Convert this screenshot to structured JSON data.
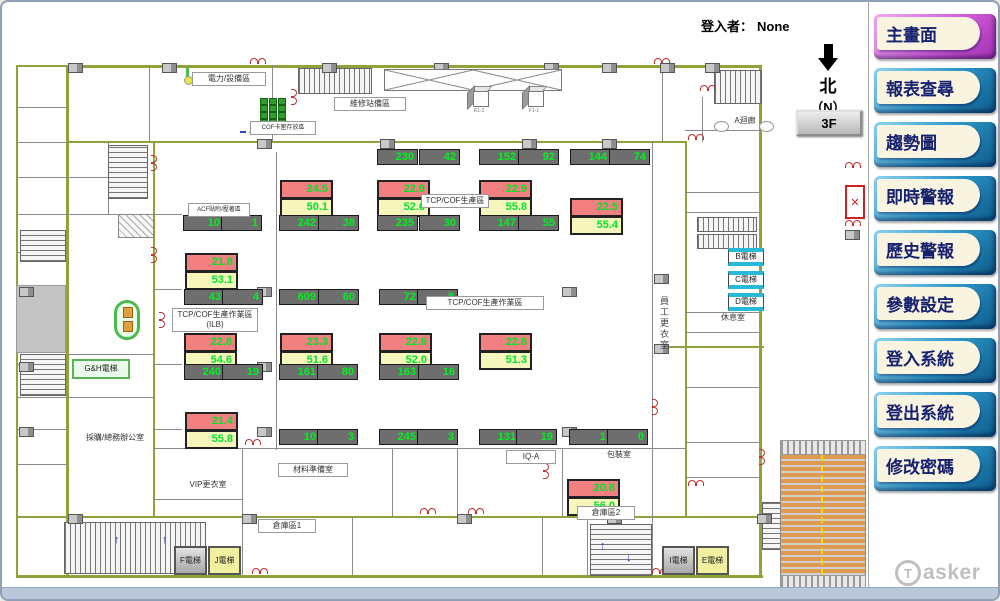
{
  "header": {
    "login_label": "登入者：",
    "login_value": "None"
  },
  "compass": {
    "char": "北",
    "sub": "（N）",
    "floor_button": "3F"
  },
  "sidebar": {
    "buttons": [
      {
        "name": "main-screen",
        "label": "主畫面",
        "active": true
      },
      {
        "name": "report-query",
        "label": "報表查尋",
        "active": false
      },
      {
        "name": "trend-chart",
        "label": "趨勢圖",
        "active": false
      },
      {
        "name": "realtime-alarm",
        "label": "即時警報",
        "active": false
      },
      {
        "name": "history-alarm",
        "label": "歷史警報",
        "active": false
      },
      {
        "name": "parameter-settings",
        "label": "參數設定",
        "active": false
      },
      {
        "name": "login-system",
        "label": "登入系統",
        "active": false
      },
      {
        "name": "logout-system",
        "label": "登出系統",
        "active": false
      },
      {
        "name": "change-password",
        "label": "修改密碼",
        "active": false
      }
    ],
    "logo": {
      "initial": "T",
      "rest": "asker"
    }
  },
  "floorplan": {
    "colors": {
      "wall": "#8fa33b",
      "temp_box": "#f28080",
      "hum_box": "#f6f6bc",
      "count_box": "#6e6e6e",
      "value_text": "#00e428"
    },
    "sensor_pairs": [
      {
        "temp": "24.5",
        "hum": "50.1",
        "x": 278,
        "y": 178
      },
      {
        "temp": "22.9",
        "hum": "52.6",
        "x": 375,
        "y": 178
      },
      {
        "temp": "22.9",
        "hum": "55.8",
        "x": 477,
        "y": 178
      },
      {
        "temp": "22.5",
        "hum": "55.4",
        "x": 568,
        "y": 196
      },
      {
        "temp": "21.8",
        "hum": "53.1",
        "x": 183,
        "y": 251
      },
      {
        "temp": "22.8",
        "hum": "54.6",
        "x": 182,
        "y": 331
      },
      {
        "temp": "23.3",
        "hum": "51.6",
        "x": 278,
        "y": 331
      },
      {
        "temp": "22.6",
        "hum": "52.0",
        "x": 377,
        "y": 331
      },
      {
        "temp": "22.8",
        "hum": "51.3",
        "x": 477,
        "y": 331
      },
      {
        "temp": "21.4",
        "hum": "55.8",
        "x": 183,
        "y": 410
      },
      {
        "temp": "20.8",
        "hum": "56.0",
        "x": 565,
        "y": 477
      }
    ],
    "counters": [
      {
        "v": "230",
        "x": 375,
        "y": 147
      },
      {
        "v": "42",
        "x": 417,
        "y": 147
      },
      {
        "v": "152",
        "x": 477,
        "y": 147
      },
      {
        "v": "92",
        "x": 516,
        "y": 147
      },
      {
        "v": "144",
        "x": 568,
        "y": 147
      },
      {
        "v": "74",
        "x": 607,
        "y": 147
      },
      {
        "v": "10",
        "x": 181,
        "y": 213
      },
      {
        "v": "1",
        "x": 219,
        "y": 213
      },
      {
        "v": "242",
        "x": 277,
        "y": 213
      },
      {
        "v": "38",
        "x": 316,
        "y": 213
      },
      {
        "v": "235",
        "x": 375,
        "y": 213
      },
      {
        "v": "30",
        "x": 417,
        "y": 213
      },
      {
        "v": "147",
        "x": 477,
        "y": 213
      },
      {
        "v": "55",
        "x": 516,
        "y": 213
      },
      {
        "v": "43",
        "x": 182,
        "y": 287
      },
      {
        "v": "4",
        "x": 220,
        "y": 287
      },
      {
        "v": "609",
        "x": 277,
        "y": 287
      },
      {
        "v": "60",
        "x": 316,
        "y": 287
      },
      {
        "v": "72",
        "x": 377,
        "y": 287
      },
      {
        "v": "8",
        "x": 415,
        "y": 287
      },
      {
        "v": "240",
        "x": 182,
        "y": 362
      },
      {
        "v": "19",
        "x": 220,
        "y": 362
      },
      {
        "v": "161",
        "x": 277,
        "y": 362
      },
      {
        "v": "80",
        "x": 315,
        "y": 362
      },
      {
        "v": "163",
        "x": 377,
        "y": 362
      },
      {
        "v": "16",
        "x": 416,
        "y": 362
      },
      {
        "v": "10",
        "x": 277,
        "y": 427
      },
      {
        "v": "3",
        "x": 315,
        "y": 427
      },
      {
        "v": "245",
        "x": 377,
        "y": 427
      },
      {
        "v": "3",
        "x": 415,
        "y": 427
      },
      {
        "v": "131",
        "x": 477,
        "y": 427
      },
      {
        "v": "19",
        "x": 514,
        "y": 427
      },
      {
        "v": "1",
        "x": 567,
        "y": 427
      },
      {
        "v": "0",
        "x": 605,
        "y": 427
      }
    ],
    "room_labels": [
      {
        "t": "電力/設備區",
        "x": 190,
        "y": 70,
        "w": 68,
        "plain": false
      },
      {
        "t": "維修站備區",
        "x": 332,
        "y": 95,
        "w": 66,
        "plain": false
      },
      {
        "t": "COF卡匣存放區",
        "x": 248,
        "y": 119,
        "w": 60,
        "plain": false,
        "small": true
      },
      {
        "t": "TCP/COF生產區",
        "x": 419,
        "y": 192,
        "w": 62,
        "plain": false
      },
      {
        "t": "ACF貼附/壓著區",
        "x": 186,
        "y": 201,
        "w": 56,
        "plain": false,
        "small": true
      },
      {
        "t": "TCP/COF生產作業區\n(ILB)",
        "x": 170,
        "y": 306,
        "w": 80,
        "plain": false
      },
      {
        "t": "TCP/COF生產作業區",
        "x": 424,
        "y": 294,
        "w": 112,
        "plain": false
      },
      {
        "t": "IQ-A",
        "x": 504,
        "y": 448,
        "w": 44,
        "plain": false
      },
      {
        "t": "包裝室",
        "x": 590,
        "y": 447,
        "w": 50,
        "plain": true
      },
      {
        "t": "材料準備室",
        "x": 276,
        "y": 461,
        "w": 64,
        "plain": false
      },
      {
        "t": "VIP更衣室",
        "x": 176,
        "y": 477,
        "w": 56,
        "plain": true
      },
      {
        "t": "倉庫區1",
        "x": 256,
        "y": 517,
        "w": 52,
        "plain": false
      },
      {
        "t": "倉庫區2",
        "x": 575,
        "y": 504,
        "w": 52,
        "plain": false
      },
      {
        "t": "採購/總務辦公室",
        "x": 74,
        "y": 430,
        "w": 74,
        "plain": true
      },
      {
        "t": "休息室",
        "x": 710,
        "y": 310,
        "w": 38,
        "plain": true
      },
      {
        "t": "A迴廊",
        "x": 726,
        "y": 113,
        "w": 30,
        "plain": true
      }
    ],
    "vertical_labels": [
      {
        "t": "員工更衣室",
        "x": 656,
        "y": 294
      }
    ],
    "elevators": [
      {
        "t": "G&H電梯",
        "x": 70,
        "y": 357,
        "w": 58,
        "h": 20,
        "style": "green"
      },
      {
        "t": "B電梯",
        "x": 726,
        "y": 246,
        "w": 36,
        "h": 18,
        "style": "cyan"
      },
      {
        "t": "C電梯",
        "x": 726,
        "y": 269,
        "w": 36,
        "h": 18,
        "style": "cyan"
      },
      {
        "t": "D電梯",
        "x": 726,
        "y": 291,
        "w": 36,
        "h": 18,
        "style": "cyan"
      },
      {
        "t": "F電梯",
        "x": 172,
        "y": 544,
        "w": 33,
        "h": 29,
        "style": "gray"
      },
      {
        "t": "J電梯",
        "x": 206,
        "y": 544,
        "w": 33,
        "h": 29,
        "style": "yellow"
      },
      {
        "t": "I電梯",
        "x": 660,
        "y": 544,
        "w": 33,
        "h": 29,
        "style": "gray"
      },
      {
        "t": "E電梯",
        "x": 694,
        "y": 544,
        "w": 33,
        "h": 29,
        "style": "yellow"
      }
    ],
    "cubes": [
      {
        "t": "R1-2",
        "x": 464,
        "y": 82
      },
      {
        "t": "F1-1",
        "x": 519,
        "y": 82
      }
    ]
  }
}
